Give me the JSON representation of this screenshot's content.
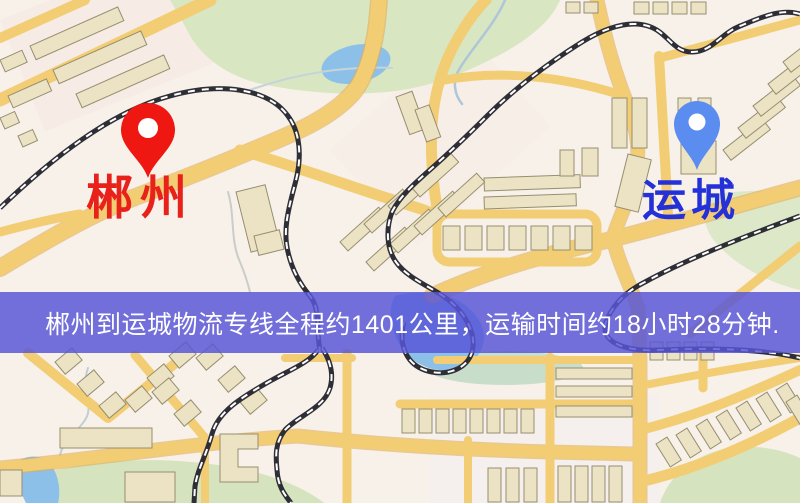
{
  "map": {
    "origin": {
      "label": "郴州",
      "marker": "red-map-pin"
    },
    "destination": {
      "label": "运城",
      "marker": "blue-map-pin"
    },
    "banner": {
      "text": "郴州到运城物流专线全程约1401公里，运输时间约18小时28分钟.",
      "distance_km": 1401,
      "duration_text": "18小时28分钟"
    }
  },
  "colors": {
    "origin_pin": "#ee1711",
    "origin_label": "#e8211a",
    "destination_pin": "#5b8cf0",
    "destination_label": "#2531d8",
    "banner_background": "#5856d7",
    "banner_text": "#ffffff",
    "road": "#f2cd74",
    "water": "#8cc0e8",
    "park": "#d8e6c2",
    "railway": "#2e2e36",
    "map_background": "#f7f1ea",
    "building": "#ece2c4"
  }
}
